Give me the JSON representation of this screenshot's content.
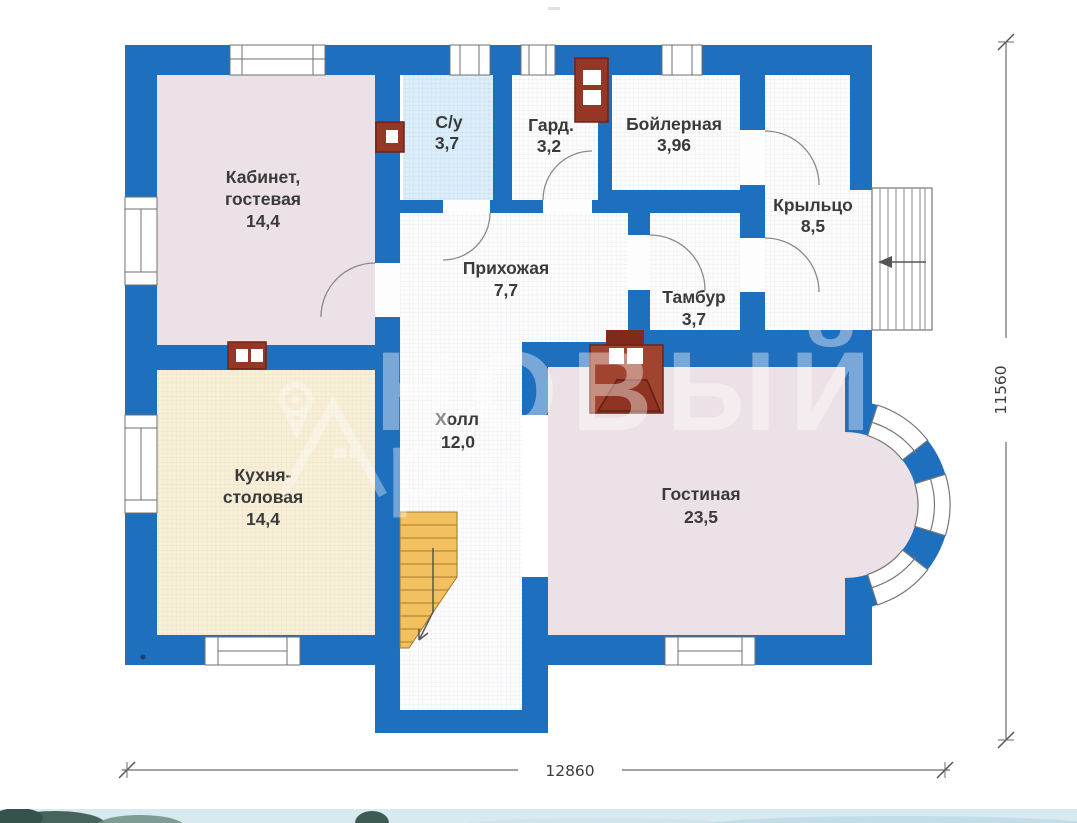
{
  "meta": {
    "type": "floor-plan",
    "floor": "first-floor-house-plan",
    "language": "ru"
  },
  "rooms": {
    "kabinet": {
      "name_line1": "Кабинет,",
      "name_line2": "гостевая",
      "area": "14,4"
    },
    "su": {
      "name": "С/у",
      "area": "3,7"
    },
    "gard": {
      "name": "Гард.",
      "area": "3,2"
    },
    "boiler": {
      "name": "Бойлерная",
      "area": "3,96"
    },
    "porch": {
      "name": "Крыльцо",
      "area": "8,5"
    },
    "hallway": {
      "name": "Прихожая",
      "area": "7,7"
    },
    "tambur": {
      "name": "Тамбур",
      "area": "3,7"
    },
    "hall": {
      "name": "Холл",
      "area": "12,0"
    },
    "kitchen": {
      "name_line1": "Кухня-",
      "name_line2": "столовая",
      "area": "14,4"
    },
    "living": {
      "name": "Гостиная",
      "area": "23,5"
    }
  },
  "dimensions": {
    "width": "12860",
    "height": "11560"
  },
  "watermark": {
    "text_main": "НОВЫЙ",
    "text_sub": "рес"
  },
  "icons": {
    "hall_stairs_arrow": "arrow-down-left",
    "porch_stairs_arrow": "arrow-left",
    "logo": "house-location-pin"
  },
  "colors": {
    "wall": "#1f6fbf",
    "room_pink": "#ece1e6",
    "room_cream": "#f8efd9",
    "room_lightblue": "#ddeef9",
    "room_white": "#fdfdfd",
    "stairs_orange": "#f2c05e",
    "brick_red": "#963726",
    "dimension_gray": "#555555"
  }
}
